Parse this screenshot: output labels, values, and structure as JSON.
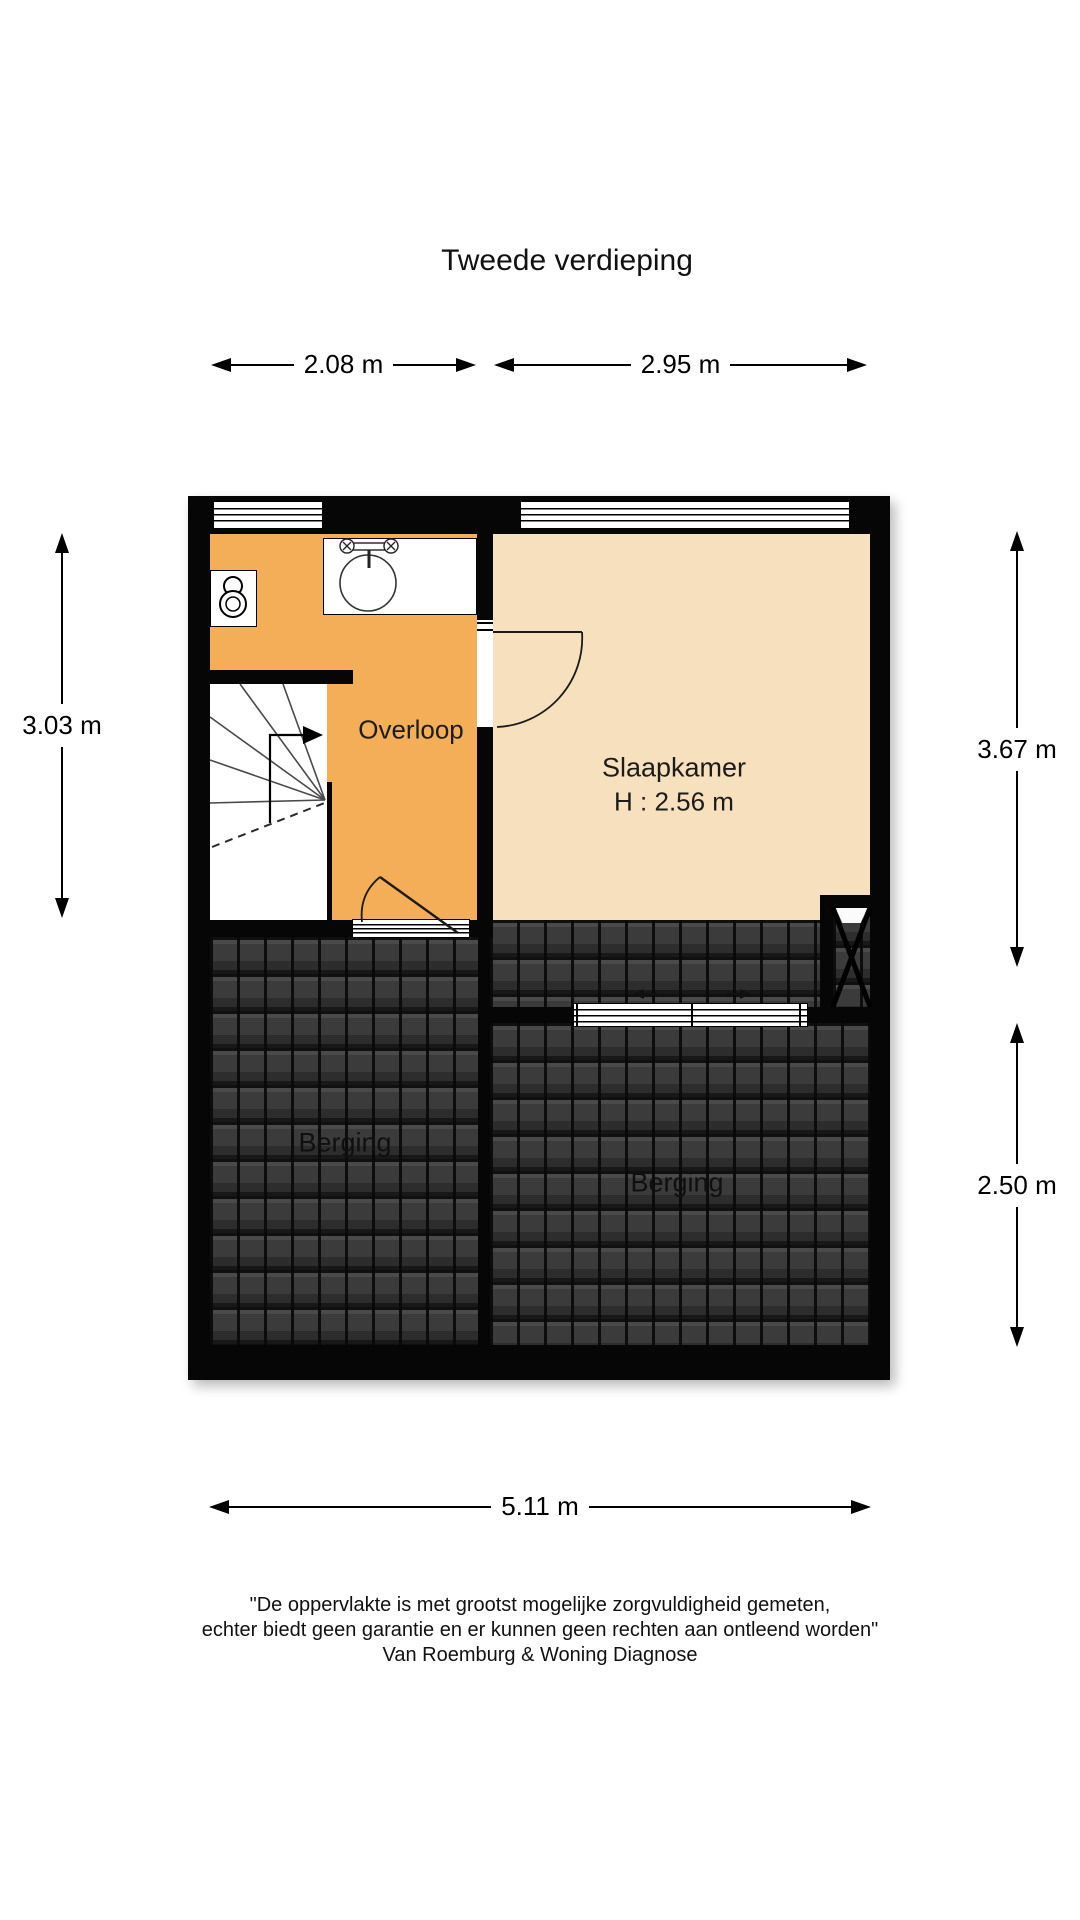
{
  "title": "Tweede verdieping",
  "dimensions": {
    "top_left": "2.08 m",
    "top_right": "2.95 m",
    "left": "3.03 m",
    "right_top": "3.67 m",
    "right_bottom": "2.50 m",
    "bottom": "5.11 m"
  },
  "rooms": {
    "overloop": {
      "label": "Overloop"
    },
    "slaapkamer": {
      "label": "Slaapkamer",
      "ceiling_height": "H : 2.56 m"
    },
    "berging_left": {
      "label": "Berging"
    },
    "berging_right": {
      "label": "Berging"
    }
  },
  "disclaimer": {
    "line1": "\"De oppervlakte is met grootst mogelijke zorgvuldigheid gemeten,",
    "line2": "echter biedt geen garantie en er kunnen geen rechten aan ontleend worden\"",
    "line3": "Van Roemburg & Woning Diagnose"
  },
  "colors": {
    "landing": "#F3AE57",
    "bedroom": "#F6E0BD",
    "wall": "#060606",
    "text": "#1a1a1a"
  }
}
